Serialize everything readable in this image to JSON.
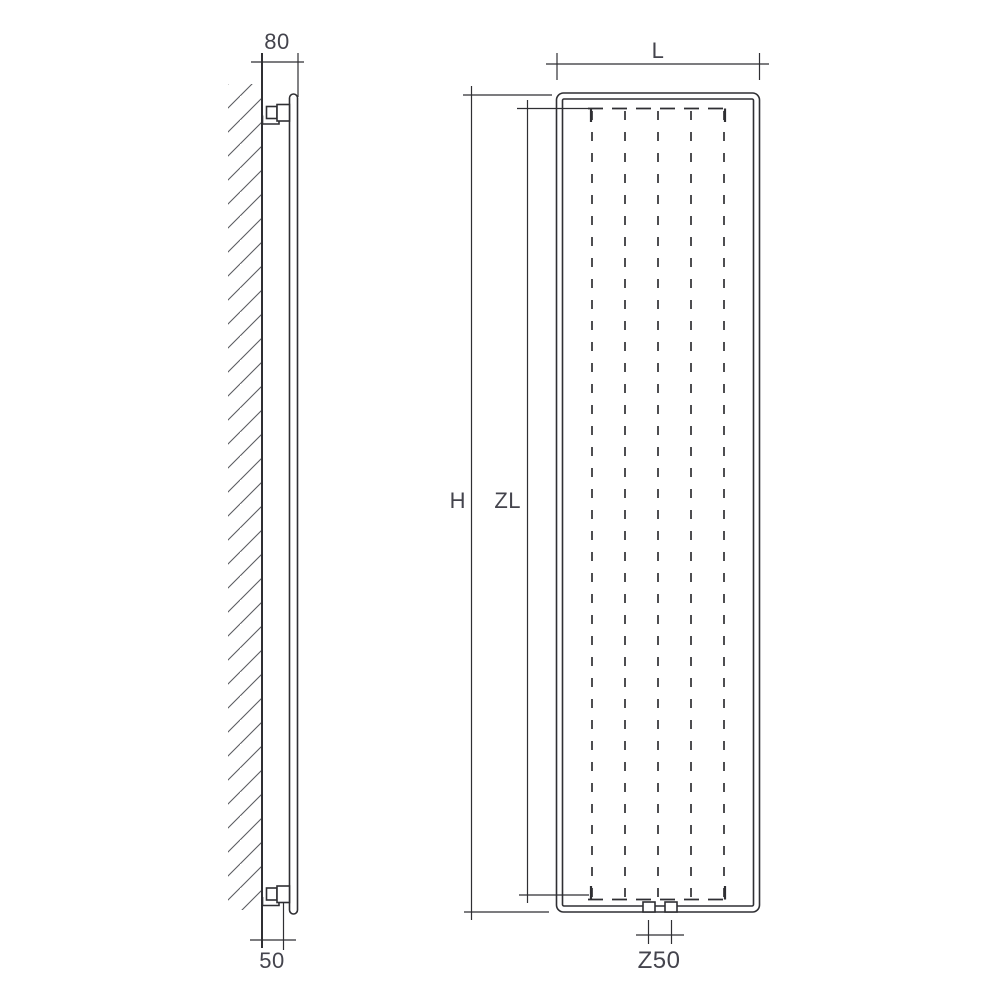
{
  "colors": {
    "background": "#ffffff",
    "line": "#2f2f33",
    "hatch": "#5b5c61",
    "text": "#44444d"
  },
  "side_view": {
    "dim_top_offset": "80",
    "dim_bottom_offset": "50"
  },
  "front_view": {
    "dim_width": "L",
    "dim_height": "H",
    "dim_channel_length": "ZL",
    "dim_connection_spacing": "Z50"
  }
}
